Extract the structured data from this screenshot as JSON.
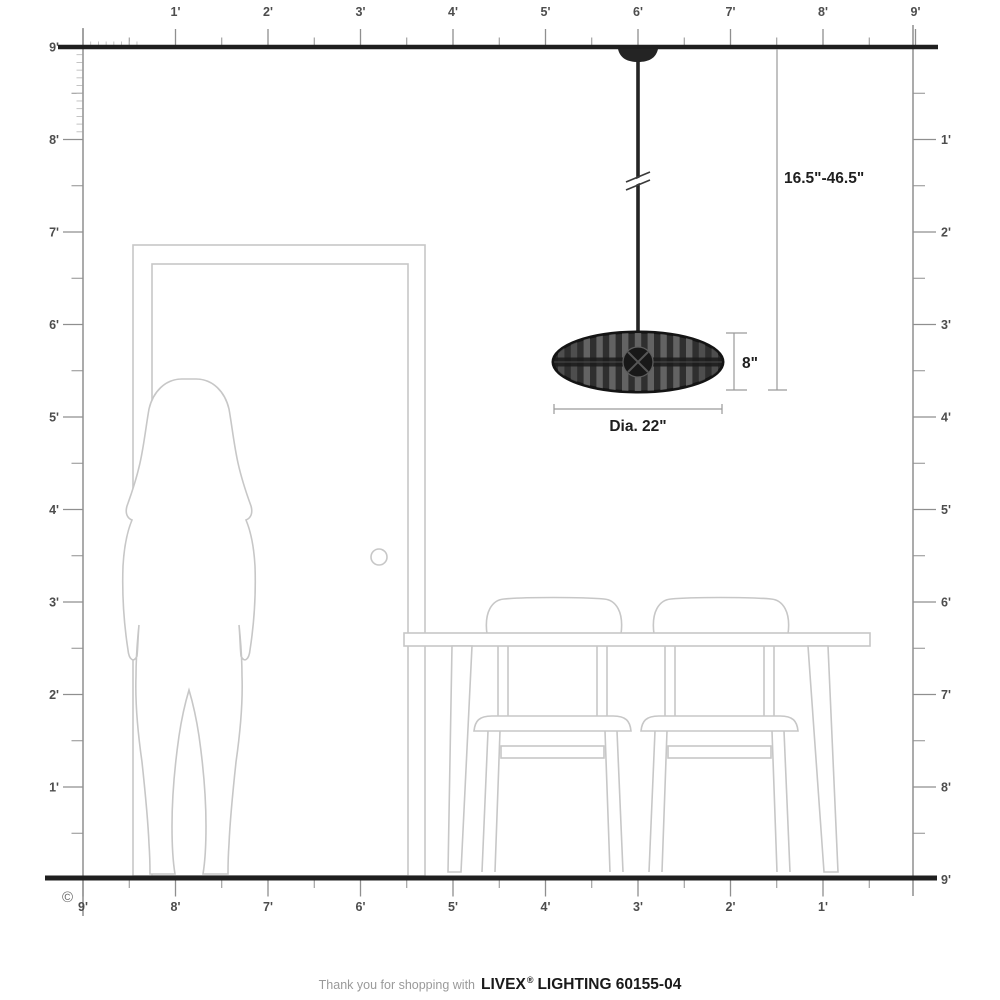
{
  "meta": {
    "copyright": "©"
  },
  "rulers": {
    "top": {
      "labels": [
        "1'",
        "2'",
        "3'",
        "4'",
        "5'",
        "6'",
        "7'",
        "8'",
        "9'"
      ]
    },
    "left": {
      "labels": [
        "9'",
        "8'",
        "7'",
        "6'",
        "5'",
        "4'",
        "3'",
        "2'",
        "1'"
      ]
    },
    "right": {
      "labels": [
        "1'",
        "2'",
        "3'",
        "4'",
        "5'",
        "6'",
        "7'",
        "8'",
        "9'"
      ]
    },
    "bottom": {
      "labels": [
        "9'",
        "8'",
        "7'",
        "6'",
        "5'",
        "4'",
        "3'",
        "2'",
        "1'"
      ]
    }
  },
  "dimensions": {
    "hanging_range": "16.5\"-46.5\"",
    "fixture_height": "8\"",
    "fixture_diameter": "Dia. 22\""
  },
  "footer": {
    "prefix": "Thank you for shopping with",
    "brand": "LIVEX",
    "registered": "®",
    "product": "LIGHTING 60155-04"
  },
  "colors": {
    "ink": "#1f1f1f",
    "ruler": "#8f8f8f",
    "label": "#4d4d4d",
    "furniture": "#c7c7c7",
    "fixture": "#2f2f2f"
  }
}
